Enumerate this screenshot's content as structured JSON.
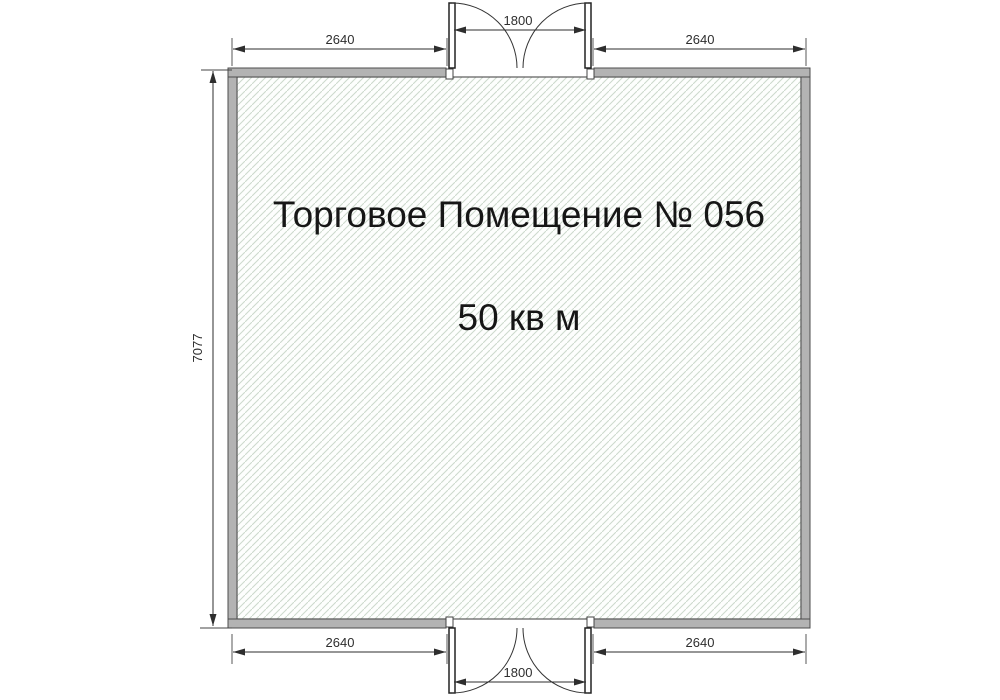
{
  "floor_plan": {
    "room": {
      "title": "Торговое Помещение № 056",
      "area": "50 кв м"
    },
    "dimensions": {
      "top_left_wall": "2640",
      "top_door": "1800",
      "top_right_wall": "2640",
      "left_wall": "7077",
      "bottom_left_wall": "2640",
      "bottom_door": "1800",
      "bottom_right_wall": "2640"
    },
    "colors": {
      "wall_fill": "#b3b3b3",
      "wall_outline": "#4d4d4d",
      "hatch_line": "#ccd9cc",
      "dimension_line": "#2e2e2e",
      "extension_line": "#8f8f8f",
      "background": "#ffffff",
      "label_text": "#161616"
    }
  }
}
